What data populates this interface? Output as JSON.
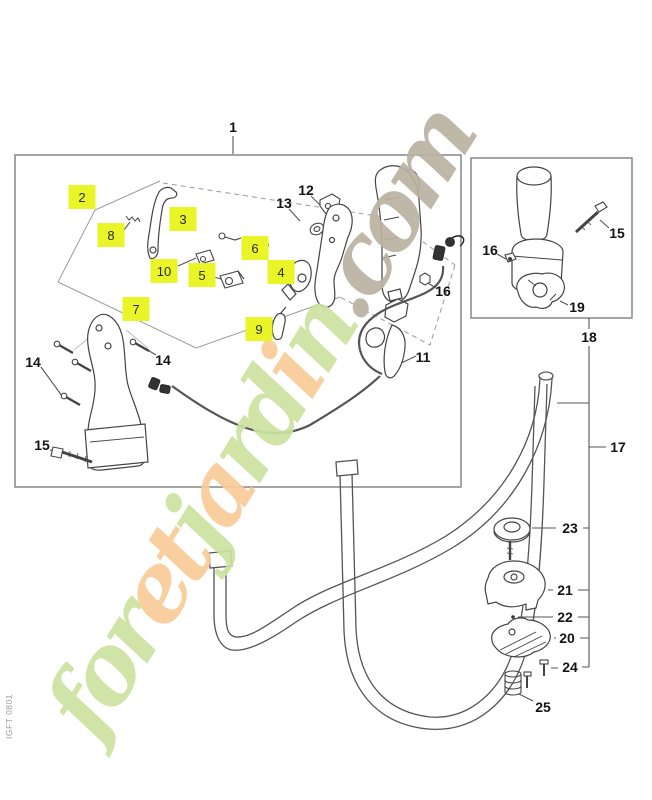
{
  "title": "Handle assembly exploded parts diagram",
  "doc_code": "IGFT 0801",
  "highlight_color": "#e9f526",
  "watermark": {
    "text": "foretjardin.com",
    "colors": {
      "green": "#cbe29f",
      "orange": "#f9cb97",
      "taupe": "#bab1a0"
    },
    "letter_styles": [
      "green",
      "green",
      "green",
      "orange",
      "orange",
      "green",
      "orange",
      "green",
      "green",
      "orange",
      "green",
      "taupe",
      "taupe",
      "taupe",
      "taupe"
    ]
  },
  "labels": [
    {
      "text": "1",
      "x": 233,
      "y": 127,
      "highlight": false
    },
    {
      "text": "2",
      "x": 82,
      "y": 197,
      "highlight": true
    },
    {
      "text": "8",
      "x": 111,
      "y": 235,
      "highlight": true
    },
    {
      "text": "3",
      "x": 183,
      "y": 219,
      "highlight": true
    },
    {
      "text": "10",
      "x": 164,
      "y": 271,
      "highlight": true
    },
    {
      "text": "5",
      "x": 202,
      "y": 275,
      "highlight": true
    },
    {
      "text": "6",
      "x": 255,
      "y": 248,
      "highlight": true
    },
    {
      "text": "4",
      "x": 281,
      "y": 272,
      "highlight": true
    },
    {
      "text": "7",
      "x": 136,
      "y": 309,
      "highlight": true
    },
    {
      "text": "9",
      "x": 259,
      "y": 329,
      "highlight": true
    },
    {
      "text": "12",
      "x": 306,
      "y": 190,
      "highlight": false
    },
    {
      "text": "13",
      "x": 284,
      "y": 203,
      "highlight": false
    },
    {
      "text": "16",
      "x": 443,
      "y": 291,
      "highlight": false
    },
    {
      "text": "11",
      "x": 423,
      "y": 357,
      "highlight": false
    },
    {
      "text": "14",
      "x": 33,
      "y": 362,
      "highlight": false
    },
    {
      "text": "14",
      "x": 163,
      "y": 360,
      "highlight": false
    },
    {
      "text": "15",
      "x": 42,
      "y": 445,
      "highlight": false
    },
    {
      "text": "15",
      "x": 617,
      "y": 233,
      "highlight": false
    },
    {
      "text": "16",
      "x": 490,
      "y": 250,
      "highlight": false
    },
    {
      "text": "19",
      "x": 577,
      "y": 307,
      "highlight": false
    },
    {
      "text": "18",
      "x": 589,
      "y": 337,
      "highlight": false
    },
    {
      "text": "17",
      "x": 618,
      "y": 447,
      "highlight": false
    },
    {
      "text": "23",
      "x": 570,
      "y": 528,
      "highlight": false
    },
    {
      "text": "21",
      "x": 565,
      "y": 590,
      "highlight": false
    },
    {
      "text": "22",
      "x": 565,
      "y": 617,
      "highlight": false
    },
    {
      "text": "20",
      "x": 567,
      "y": 638,
      "highlight": false
    },
    {
      "text": "24",
      "x": 570,
      "y": 667,
      "highlight": false
    },
    {
      "text": "25",
      "x": 543,
      "y": 707,
      "highlight": false
    }
  ]
}
